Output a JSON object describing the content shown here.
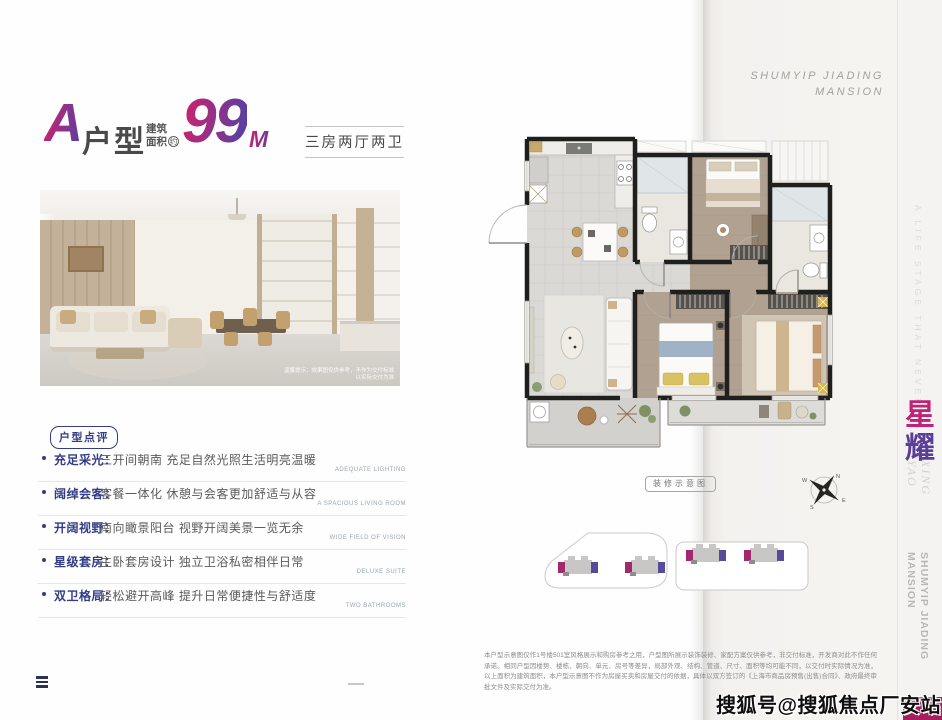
{
  "brand": {
    "top_right": "SHUMYIP JIADING\nMANSION",
    "side_tagline": "A LIFE STAGE THAT NEVER FADES",
    "side_cn_1": "星",
    "side_cn_2": "耀",
    "side_en": "XING\nYAO",
    "side_bottom": "SHUMYIP JIADING\nMANSION"
  },
  "header": {
    "unit_letter": "A",
    "unit_word": "户型",
    "area_label_l1": "建筑",
    "area_label_l2": "面积",
    "area_circle": "约",
    "area_value": "99",
    "area_unit": "M",
    "area_sup": "2",
    "layout": "三房两厅两卫"
  },
  "photo": {
    "caption_l1": "温馨提示：效果图仅供参考，不作为交付标准",
    "caption_l2": "以实际交付为准"
  },
  "review": {
    "badge": "户型点评",
    "items": [
      {
        "label": "充足采光：",
        "text": "三开间朝南 充足自然光照生活明亮温暖",
        "en": "ADEQUATE LIGHTING"
      },
      {
        "label": "阔绰会客：",
        "text": "客餐一体化 休憩与会客更加舒适与从容",
        "en": "A SPACIOUS LIVING ROOM"
      },
      {
        "label": "开阔视野：",
        "text": "南向瞰景阳台 视野开阔美景一览无余",
        "en": "WIDE FIELD OF VISION"
      },
      {
        "label": "星级套房：",
        "text": "主卧套房设计 独立卫浴私密相伴日常",
        "en": "DELUXE SUITE"
      },
      {
        "label": "双卫格局：",
        "text": "轻松避开高峰 提升日常便捷性与舒适度",
        "en": "TWO BATHROOMS"
      }
    ]
  },
  "floorplan": {
    "tag": "装修示意图",
    "compass_n": "N",
    "compass_e": "E",
    "compass_s": "S",
    "compass_w": "W"
  },
  "disclaimer": "本户型示意图仅作1号楼501室风格展示和购房参考之用，户型图所展示装饰装修、家配方案仅供参考，非交付标准，开发商对此不作任何承诺。相同户型因楼势、楼栋、朝向、单元、房号等差异，局部外观、结构、管道、尺寸、面积等均可能不同，以交付时实际情况为准，以上面积为建筑面积，本户型示意图不作为房屋买卖和房屋交付的依据，具体以双方签订的《上海市商品房预售(出售)合同》、政府最终审批文件及实际交付为准。",
  "watermark": "搜狐号@搜狐焦点厂安站",
  "colors": {
    "accent_magenta": "#bf2478",
    "accent_purple": "#5b3e97",
    "review_navy": "#323d85",
    "corner_block": "#a81d5c"
  }
}
